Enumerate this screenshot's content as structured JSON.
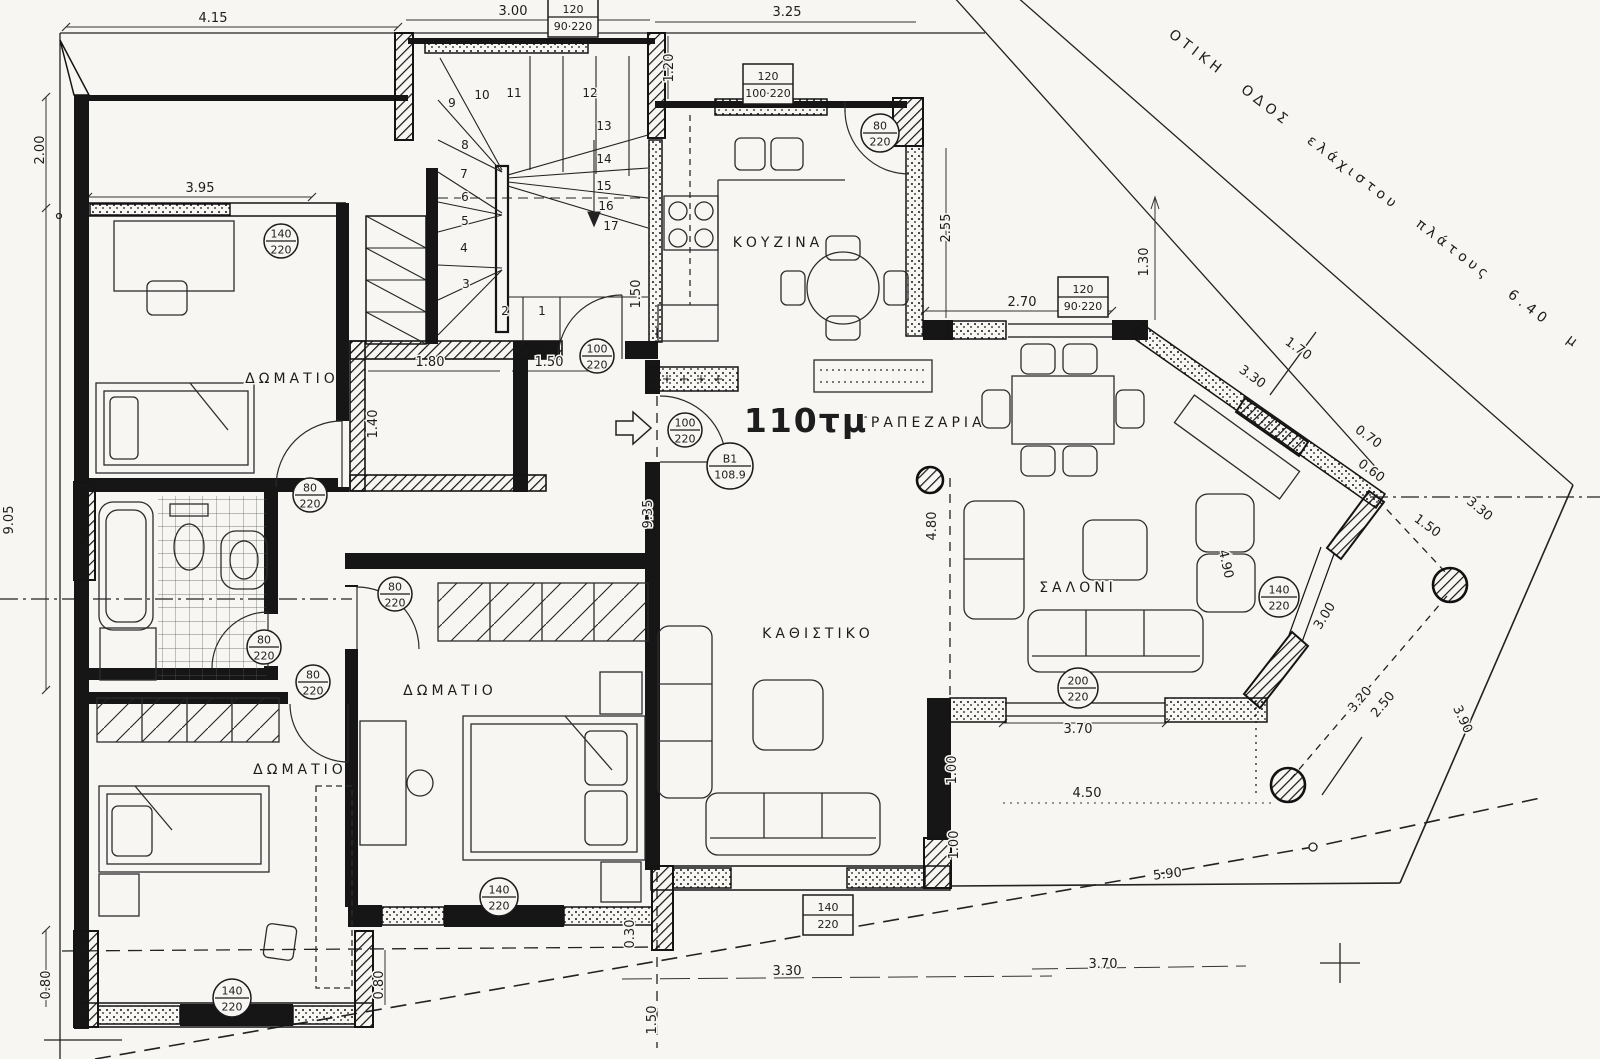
{
  "plan": {
    "area_label": {
      "text": "110τμ",
      "x": 806,
      "y": 432
    },
    "unit_tag": {
      "top": "Β1",
      "bottom": "108.9",
      "x": 730,
      "y": 466,
      "r": 23
    },
    "street_label": {
      "text": "ΟΤΙΚΗ ΟΔΟΣ ελάχιστου πλάτους 6.40 μ",
      "x": 1168,
      "y": 36,
      "rot": 37.5
    },
    "rooms": [
      {
        "text": "ΔΩΜΑΤΙΟ",
        "x": 292,
        "y": 383
      },
      {
        "text": "ΔΩΜΑΤΙΟ",
        "x": 450,
        "y": 695
      },
      {
        "text": "ΔΩΜΑΤΙΟ",
        "x": 300,
        "y": 774
      },
      {
        "text": "ΚΟΥΖΙΝΑ",
        "x": 778,
        "y": 247
      },
      {
        "text": "ΤΡΑΠΕΖΑΡΙΑ",
        "x": 922,
        "y": 427
      },
      {
        "text": "ΣΑΛΟΝΙ",
        "x": 1078,
        "y": 592
      },
      {
        "text": "ΚΑΘΙΣΤΙΚΟ",
        "x": 818,
        "y": 638
      }
    ],
    "dimensions": [
      {
        "text": "4.15",
        "x": 213,
        "y": 22,
        "rot": 0
      },
      {
        "text": "3.00",
        "x": 513,
        "y": 15,
        "rot": 0
      },
      {
        "text": "3.25",
        "x": 787,
        "y": 16,
        "rot": 0
      },
      {
        "text": "3.95",
        "x": 200,
        "y": 192,
        "rot": 0
      },
      {
        "text": "1.80",
        "x": 430,
        "y": 366,
        "rot": 0
      },
      {
        "text": "1.50",
        "x": 549,
        "y": 366,
        "rot": 0
      },
      {
        "text": "2.70",
        "x": 1022,
        "y": 306,
        "rot": 0
      },
      {
        "text": "3.70",
        "x": 1078,
        "y": 733,
        "rot": 0
      },
      {
        "text": "4.50",
        "x": 1087,
        "y": 797,
        "rot": 0
      },
      {
        "text": "5.90",
        "x": 1168,
        "y": 878,
        "rot": -7
      },
      {
        "text": "3.30",
        "x": 787,
        "y": 975,
        "rot": 0
      },
      {
        "text": "3.70",
        "x": 1103,
        "y": 968,
        "rot": 0
      },
      {
        "text": "2.00",
        "x": 44,
        "y": 150,
        "rot": -90
      },
      {
        "text": "9.05",
        "x": 13,
        "y": 520,
        "rot": -90
      },
      {
        "text": "1.20",
        "x": 673,
        "y": 68,
        "rot": -90
      },
      {
        "text": "2.55",
        "x": 950,
        "y": 228,
        "rot": -90
      },
      {
        "text": "1.30",
        "x": 1148,
        "y": 262,
        "rot": -90
      },
      {
        "text": "1.40",
        "x": 377,
        "y": 424,
        "rot": -90
      },
      {
        "text": "1.50",
        "x": 640,
        "y": 294,
        "rot": -90,
        "fs": 12
      },
      {
        "text": "9.35",
        "x": 652,
        "y": 514,
        "rot": -90
      },
      {
        "text": "4.80",
        "x": 936,
        "y": 526,
        "rot": -90
      },
      {
        "text": "1.00",
        "x": 956,
        "y": 770,
        "rot": -90,
        "fs": 12
      },
      {
        "text": "1.00",
        "x": 958,
        "y": 845,
        "rot": -90,
        "fs": 12
      },
      {
        "text": "0.30",
        "x": 634,
        "y": 934,
        "rot": -90,
        "fs": 11
      },
      {
        "text": "1.50",
        "x": 656,
        "y": 1020,
        "rot": -90
      },
      {
        "text": "0.80",
        "x": 50,
        "y": 985,
        "rot": -90
      },
      {
        "text": "0.80",
        "x": 383,
        "y": 985,
        "rot": -90
      },
      {
        "text": "3.30",
        "x": 1250,
        "y": 380,
        "rot": 36
      },
      {
        "text": "1.70",
        "x": 1296,
        "y": 352,
        "rot": 36
      },
      {
        "text": "0.70",
        "x": 1366,
        "y": 440,
        "rot": 36
      },
      {
        "text": "0.60",
        "x": 1369,
        "y": 474,
        "rot": 36
      },
      {
        "text": "1.50",
        "x": 1425,
        "y": 529,
        "rot": 36
      },
      {
        "text": "3.30",
        "x": 1477,
        "y": 512,
        "rot": 40
      },
      {
        "text": "3.00",
        "x": 1328,
        "y": 618,
        "rot": -58
      },
      {
        "text": "4.90",
        "x": 1222,
        "y": 565,
        "rot": 77
      },
      {
        "text": "3.20",
        "x": 1363,
        "y": 702,
        "rot": -50
      },
      {
        "text": "2.50",
        "x": 1386,
        "y": 707,
        "rot": -50,
        "fs": 16
      },
      {
        "text": "3.90",
        "x": 1459,
        "y": 721,
        "rot": 65
      }
    ],
    "door_tags": [
      {
        "top": "140",
        "bottom": "220",
        "x": 281,
        "y": 241,
        "r": 17
      },
      {
        "top": "100",
        "bottom": "220",
        "x": 597,
        "y": 356,
        "r": 17
      },
      {
        "top": "100",
        "bottom": "220",
        "x": 685,
        "y": 430,
        "r": 17
      },
      {
        "top": "80",
        "bottom": "220",
        "x": 880,
        "y": 133,
        "r": 19
      },
      {
        "top": "80",
        "bottom": "220",
        "x": 310,
        "y": 495,
        "r": 17
      },
      {
        "top": "80",
        "bottom": "220",
        "x": 395,
        "y": 594,
        "r": 17
      },
      {
        "top": "80",
        "bottom": "220",
        "x": 264,
        "y": 647,
        "r": 17
      },
      {
        "top": "80",
        "bottom": "220",
        "x": 313,
        "y": 682,
        "r": 17
      },
      {
        "top": "140",
        "bottom": "220",
        "x": 1279,
        "y": 597,
        "r": 20
      },
      {
        "top": "200",
        "bottom": "220",
        "x": 1078,
        "y": 688,
        "r": 20
      },
      {
        "top": "140",
        "bottom": "220",
        "x": 499,
        "y": 897,
        "r": 19
      },
      {
        "top": "140",
        "bottom": "220",
        "x": 232,
        "y": 998,
        "r": 19
      }
    ],
    "window_boxes": [
      {
        "top": "120",
        "bottom": "90·220",
        "x": 573,
        "y": 17
      },
      {
        "top": "120",
        "bottom": "100·220",
        "x": 768,
        "y": 84
      },
      {
        "top": "120",
        "bottom": "90·220",
        "x": 1083,
        "y": 297
      },
      {
        "top": "140",
        "bottom": "220",
        "x": 828,
        "y": 915
      }
    ],
    "stair_numbers": [
      {
        "n": "1",
        "x": 542,
        "y": 315
      },
      {
        "n": "2",
        "x": 505,
        "y": 315
      },
      {
        "n": "3",
        "x": 466,
        "y": 288
      },
      {
        "n": "4",
        "x": 464,
        "y": 252
      },
      {
        "n": "5",
        "x": 465,
        "y": 225
      },
      {
        "n": "6",
        "x": 465,
        "y": 201
      },
      {
        "n": "7",
        "x": 464,
        "y": 178
      },
      {
        "n": "8",
        "x": 465,
        "y": 149
      },
      {
        "n": "9",
        "x": 452,
        "y": 107
      },
      {
        "n": "10",
        "x": 482,
        "y": 99
      },
      {
        "n": "11",
        "x": 514,
        "y": 97
      },
      {
        "n": "12",
        "x": 590,
        "y": 97
      },
      {
        "n": "13",
        "x": 604,
        "y": 130
      },
      {
        "n": "14",
        "x": 604,
        "y": 163
      },
      {
        "n": "15",
        "x": 604,
        "y": 190
      },
      {
        "n": "16",
        "x": 606,
        "y": 210
      },
      {
        "n": "17",
        "x": 611,
        "y": 230
      }
    ]
  }
}
